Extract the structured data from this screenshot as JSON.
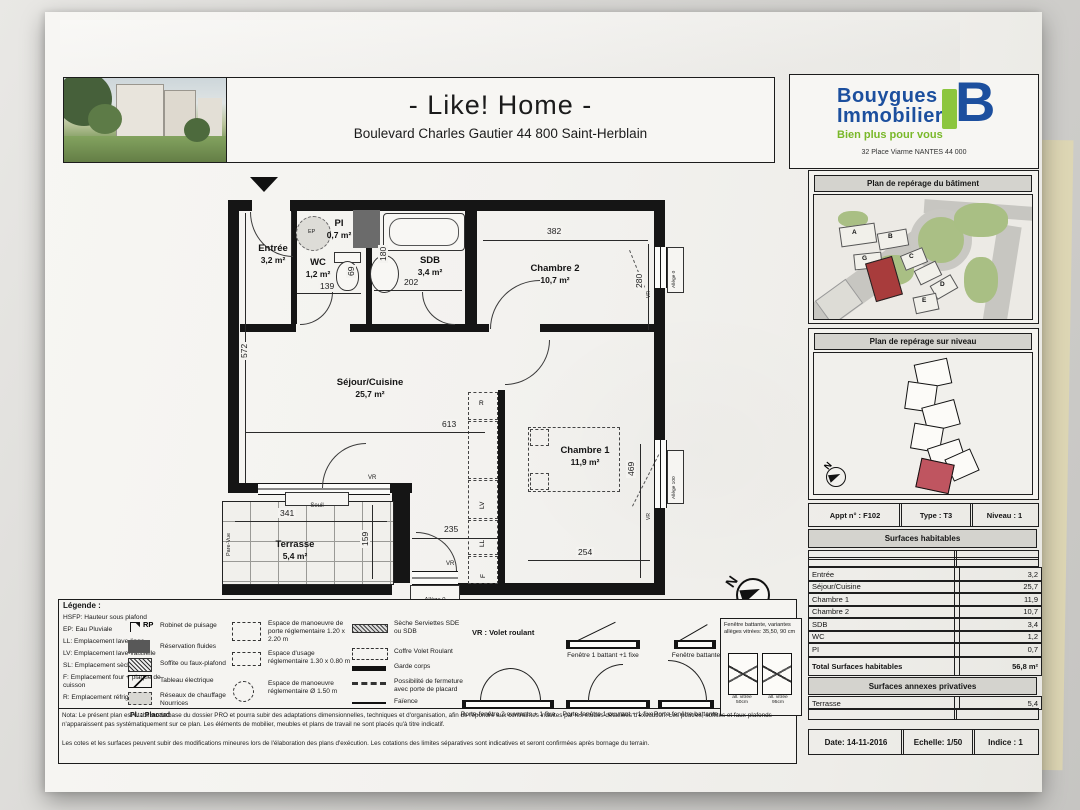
{
  "header": {
    "title": "- Like! Home -",
    "subtitle": "Boulevard Charles Gautier 44 800 Saint-Herblain"
  },
  "brand": {
    "name_line1": "Bouygues",
    "name_line2": "Immobilier",
    "tagline": "Bien plus pour vous",
    "address": "32 Place Viarme NANTES 44 000",
    "logo_letter": "B",
    "blue": "#1c4f9e",
    "green": "#79b829"
  },
  "sidebar": {
    "building_map_title": "Plan de repérage du bâtiment",
    "level_map_title": "Plan de repérage sur niveau",
    "building_labels": [
      "A",
      "B",
      "G",
      "C",
      "D",
      "E"
    ],
    "north_label": "N",
    "info": {
      "apt": "Appt n° : F102",
      "type": "Type : T3",
      "level": "Niveau : 1"
    },
    "surfaces_title": "Surfaces habitables",
    "surfaces": [
      {
        "label": "Entrée",
        "value": "3,2"
      },
      {
        "label": "Séjour/Cuisine",
        "value": "25,7"
      },
      {
        "label": "Chambre 1",
        "value": "11,9"
      },
      {
        "label": "Chambre 2",
        "value": "10,7"
      },
      {
        "label": "SDB",
        "value": "3,4"
      },
      {
        "label": "WC",
        "value": "1,2"
      },
      {
        "label": "PI",
        "value": "0,7"
      }
    ],
    "total_label": "Total Surfaces habitables",
    "total_value": "56,8 m²",
    "annex_title": "Surfaces annexes privatives",
    "annex": [
      {
        "label": "Terrasse",
        "value": "5,4"
      }
    ],
    "footer": {
      "date": "Date: 14-11-2016",
      "scale": "Echelle: 1/50",
      "index": "Indice : 1"
    }
  },
  "plan": {
    "north_label": "N",
    "rooms": {
      "entree": {
        "name": "Entrée",
        "area": "3,2 m²"
      },
      "pi": {
        "name": "PI",
        "area": "0,7 m²"
      },
      "wc": {
        "name": "WC",
        "area": "1,2 m²"
      },
      "sdb": {
        "name": "SDB",
        "area": "3,4 m²"
      },
      "chambre2": {
        "name": "Chambre 2",
        "area": "10,7 m²"
      },
      "sejour": {
        "name": "Séjour/Cuisine",
        "area": "25,7 m²"
      },
      "chambre1": {
        "name": "Chambre 1",
        "area": "11,9 m²"
      },
      "terrasse": {
        "name": "Terrasse",
        "area": "5,4 m²"
      }
    },
    "dims": {
      "d382": "382",
      "d280": "280",
      "d572": "572",
      "d613": "613",
      "d341": "341",
      "d159": "159",
      "d235": "235",
      "d254": "254",
      "d469": "469",
      "d139": "139",
      "d202": "202",
      "d69": "69",
      "d180": "180"
    },
    "labels": {
      "vr": "VR",
      "seuil": "Seuil",
      "pare_vue": "Pare-Vue",
      "allege_0": "Allège 0",
      "allege_100": "Allège 100",
      "ep": "EP",
      "r": "R",
      "lv": "LV",
      "ll": "LL",
      "f": "F"
    }
  },
  "legend": {
    "title": "Légende :",
    "abbreviations": [
      "HSFP: Hauteur sous plafond",
      "EP: Eau Pluviale",
      "LL: Emplacement lave-linge",
      "LV: Emplacement lave-vaisselle",
      "SL: Emplacement sèche-linge",
      "F: Emplacement four + plaque de cuisson",
      "R: Emplacement réfrigérateur"
    ],
    "rp_key": "RP",
    "col2": [
      "Robinet de puisage",
      "Réservation fluides",
      "Soffite ou faux-plafond",
      "Tableau électrique",
      "Réseaux de chauffage Nourrices"
    ],
    "placard_note": "Pl. : Placard",
    "col3": [
      "Espace de manoeuvre de porte réglementaire 1.20 x 2.20 m",
      "Espace d'usage réglementaire 1.30 x 0.80 m",
      "Espace de manoeuvre réglementaire Ø 1.50 m"
    ],
    "col4": [
      "Sèche Serviettes SDE ou SDB",
      "Coffre Volet Roulant",
      "Garde corps",
      "Possibilité de fermeture avec porte de placard",
      "Faïence"
    ],
    "vr_note": "VR : Volet roulant",
    "window_labels": [
      "Fenêtre 1 battant +1 fixe",
      "Fenêtre battante"
    ],
    "door_labels": [
      "Porte-fenêtre 2 ouvrants + 1 fixe",
      "Porte-fenêtre 1 ouvrant + 1 fixe",
      "Porte-fenêtre battante"
    ],
    "variants": {
      "title": "Fenêtre battante, variantes allèges vitrées: 35,50, 90 cm",
      "a": "all. vitrée 50cm",
      "b": "all. vitrée 95cm"
    }
  },
  "nota": {
    "p1": "Nota: Le présent plan est établi sur la base du dossier PRO et pourra subir des adaptations dimensionnelles, techniques et d'organisation, afin de répondre aux contraintes induites par les études détaillées d'exécution. Les poutres, soffites et faux-plafonds n'apparaissent pas systématiquement sur ce plan. Les éléments de mobilier, meubles et plans de travail ne sont placés qu'à titre indicatif.",
    "p2": "Les cotes et les surfaces peuvent subir des modifications mineures lors de l'élaboration des plans d'exécution. Les cotations des limites séparatives sont indicatives et seront confirmées après bornage du terrain."
  }
}
